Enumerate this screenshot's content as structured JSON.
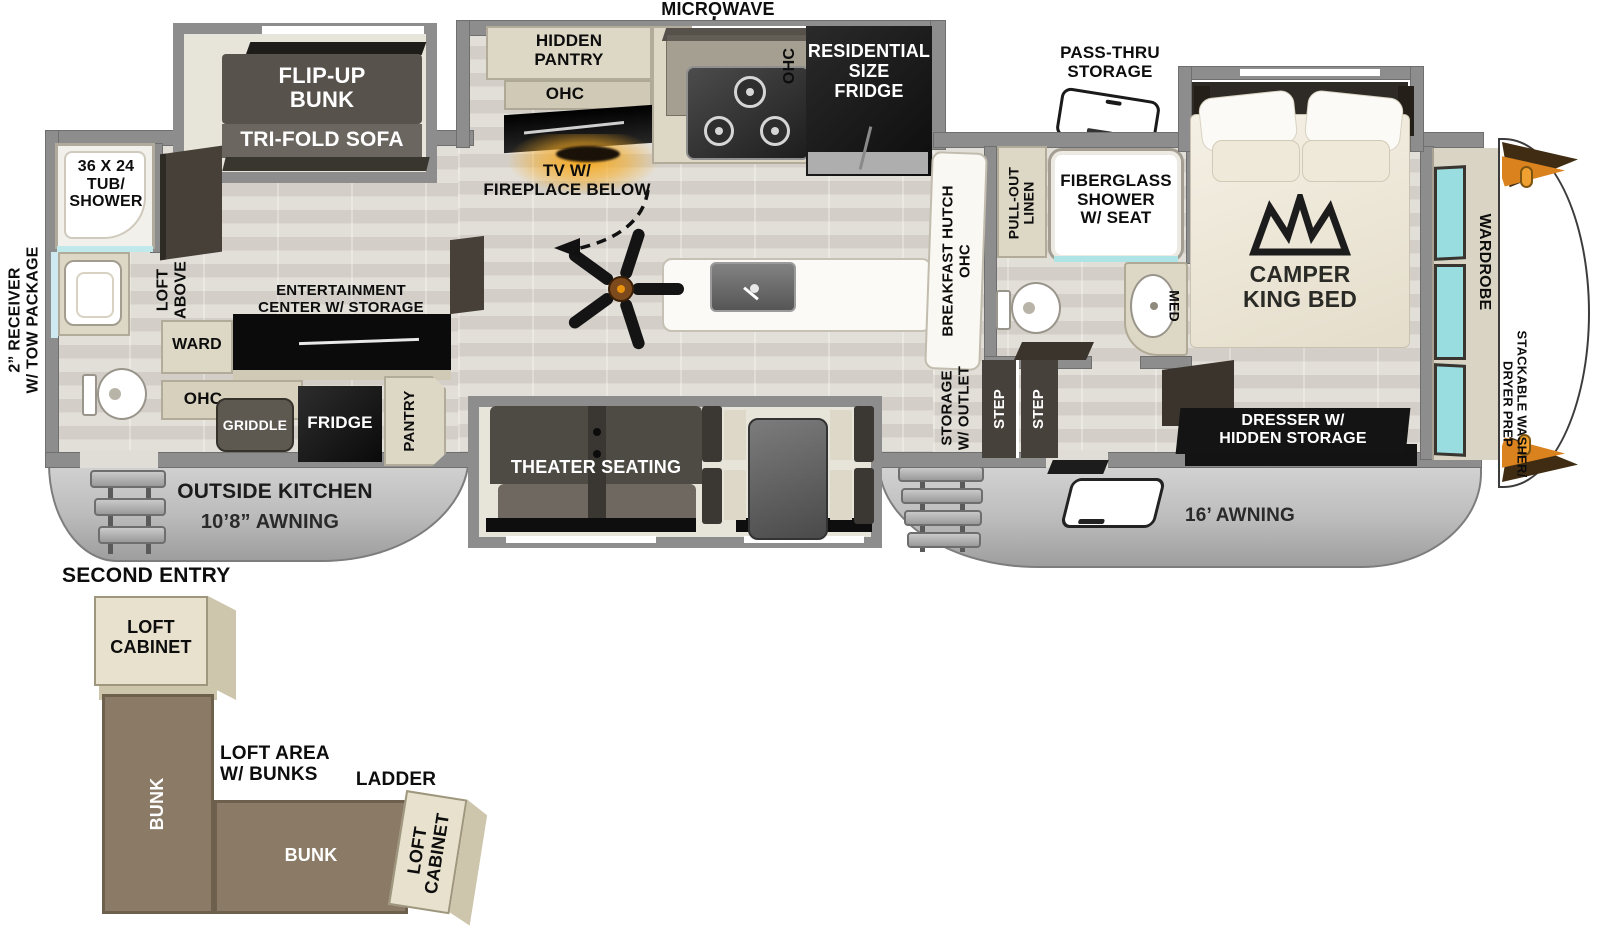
{
  "colors": {
    "wall_gray": "#8d8d8d",
    "floor_wood": "#dbd8d2",
    "cabinet_beige": "#ddd7c5",
    "furniture_dark": "#55504a",
    "appliance_black": "#111111",
    "window_teal": "#9adde0",
    "fireplace_orange": "#f6a91e",
    "bunk_brown": "#8a7a66",
    "awning_gray": "#c4c4c4"
  },
  "exterior": {
    "receiver": "2” RECEIVER\nW/ TOW PACKAGE",
    "pass_thru": "PASS-THRU\nSTORAGE",
    "microwave": "MICROWAVE",
    "outside_kitchen": "OUTSIDE KITCHEN",
    "awning_left": "10’8” AWNING",
    "awning_right": "16’ AWNING",
    "second_entry": "SECOND ENTRY"
  },
  "rear": {
    "flip_up_bunk": "FLIP-UP\nBUNK",
    "tri_fold_sofa": "TRI-FOLD SOFA",
    "tub_shower": "36 X 24\nTUB/\nSHOWER",
    "loft_above": "LOFT\nABOVE",
    "entertainment": "ENTERTAINMENT\nCENTER W/ STORAGE",
    "ward": "WARD",
    "ohc": "OHC",
    "griddle": "GRIDDLE",
    "fridge": "FRIDGE",
    "pantry": "PANTRY"
  },
  "kitchen": {
    "hidden_pantry": "HIDDEN\nPANTRY",
    "ohc_tv": "OHC",
    "tv_fireplace": "TV W/\nFIREPLACE BELOW",
    "ohc_range": "OHC",
    "res_fridge": "RESIDENTIAL\nSIZE\nFRIDGE",
    "theater": "THEATER SEATING",
    "breakfast_hutch": "BREAKFAST HUTCH\nOHC"
  },
  "bath": {
    "pull_out_linen": "PULL-OUT\nLINEN",
    "shower": "FIBERGLASS\nSHOWER\nW/ SEAT",
    "med": "MED",
    "storage_outlet": "STORAGE\nW/ OUTLET",
    "step": "STEP"
  },
  "bedroom": {
    "king_bed": "CAMPER\nKING BED",
    "dresser": "DRESSER W/\nHIDDEN STORAGE",
    "wardrobe": "WARDROBE",
    "washer_dryer": "STACKABLE WASHER/\nDRYER PREP"
  },
  "loft": {
    "cabinet": "LOFT\nCABINET",
    "bunk": "BUNK",
    "area": "LOFT AREA\nW/ BUNKS",
    "ladder": "LADDER"
  }
}
